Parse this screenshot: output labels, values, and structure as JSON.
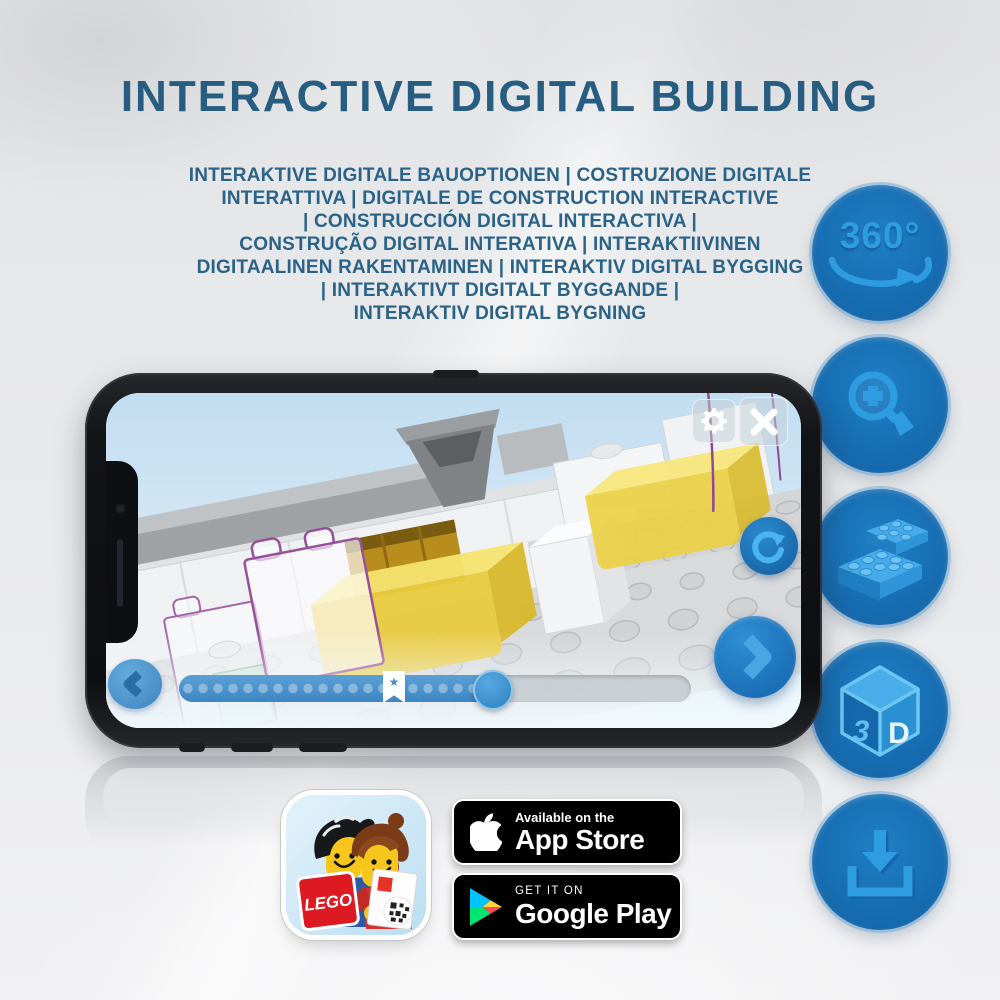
{
  "header": {
    "title": "INTERACTIVE DIGITAL BUILDING",
    "subtitle_lines": [
      "INTERAKTIVE DIGITALE BAUOPTIONEN | COSTRUZIONE DIGITALE",
      "INTERATTIVA | DIGITALE DE CONSTRUCTION INTERACTIVE",
      "| CONSTRUCCIÓN DIGITAL INTERACTIVA |",
      "CONSTRUÇÃO DIGITAL INTERATIVA | INTERAKTIIVINEN",
      "DIGITAALINEN RAKENTAMINEN | INTERAKTIV DIGITAL BYGGING",
      "| INTERAKTIVT DIGITALT BYGGANDE |",
      "INTERAKTIV DIGITAL BYGNING"
    ]
  },
  "features": {
    "rotation_label": "360°",
    "cube_three": "3",
    "cube_d": "D"
  },
  "phone_app": {
    "slider": {
      "progress_percent": 61,
      "bookmark_percent": 42,
      "star_glyph": "★"
    }
  },
  "store": {
    "lego_logo_text": "LEGO",
    "app_store": {
      "tagline": "Available on the",
      "name": "App Store"
    },
    "google_play": {
      "tagline": "GET IT ON",
      "name": "Google Play"
    }
  },
  "colors": {
    "title_blue": "#265d80",
    "feature_circle_blue": "#1670b4",
    "feature_glyph_blue": "#2d9ce0",
    "slider_blue": "#3d86c4",
    "badge_black": "#000000",
    "lego_red": "#dd1a21",
    "ghost_outline_purple": "#97519c",
    "brick_yellow": "#eacc3e"
  }
}
